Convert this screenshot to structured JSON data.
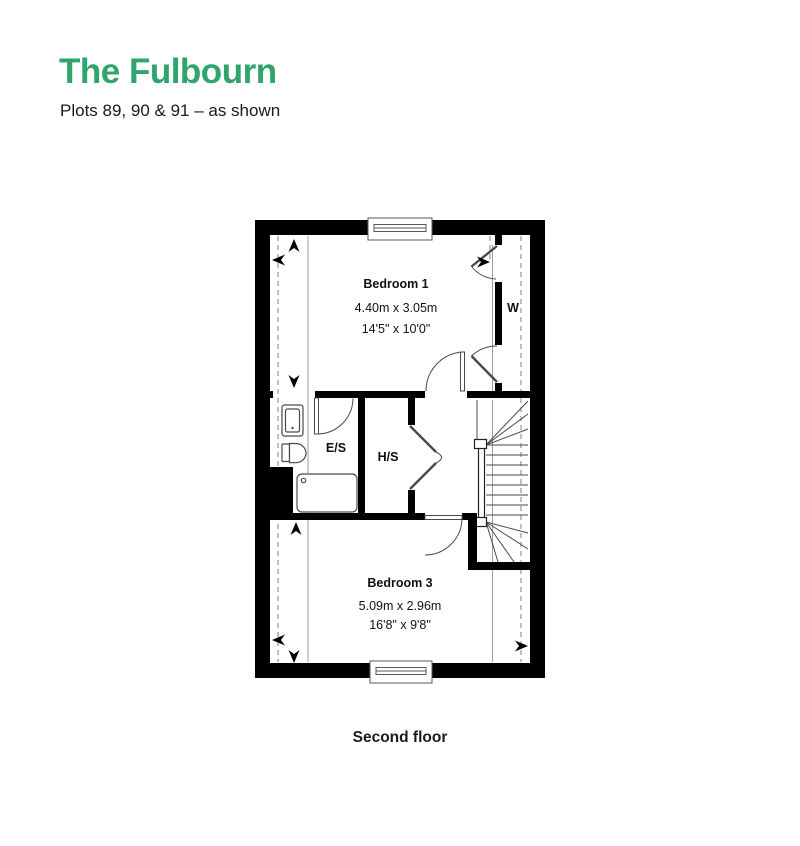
{
  "page": {
    "title": "The Fulbourn",
    "subtitle": "Plots 89, 90 & 91 – as shown",
    "caption": "Second floor"
  },
  "colors": {
    "accent_green": "#2FA46B",
    "text": "#1A1A1A",
    "wall": "#000000",
    "plan_line": "#444444",
    "guide_line": "#9E9E9E"
  },
  "rooms": [
    {
      "name": "Bedroom 1",
      "metric": "4.40m x 3.05m",
      "imperial": "14'5\" x 10'0\""
    },
    {
      "name": "Bedroom 3",
      "metric": "5.09m x 2.96m",
      "imperial": "16'8\" x 9'8\""
    }
  ],
  "labels": {
    "ensuite": "E/S",
    "store": "H/S",
    "wardrobe": "W"
  }
}
